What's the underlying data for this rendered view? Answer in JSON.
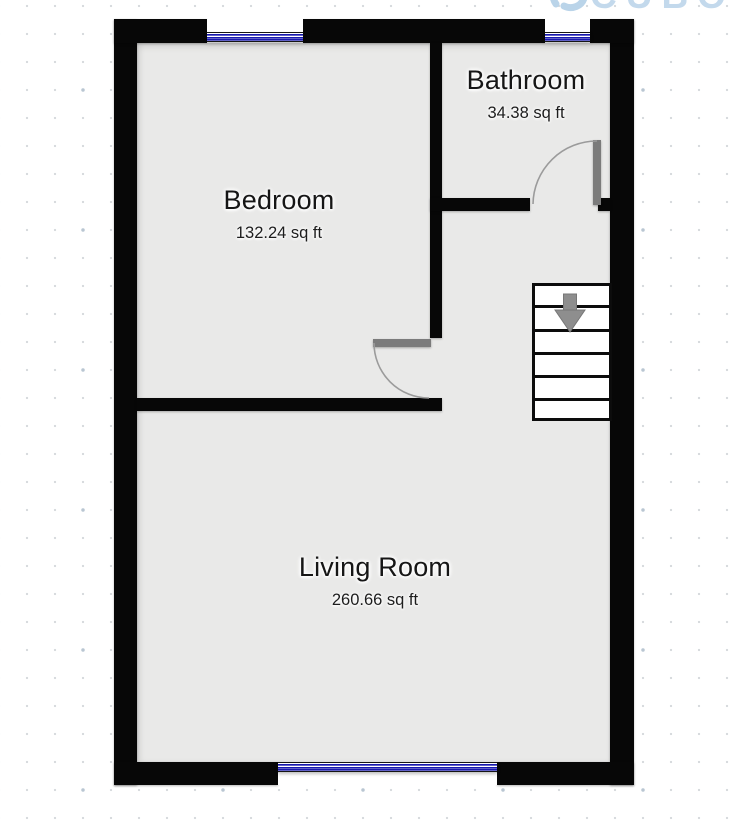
{
  "watermark": {
    "text": "CUBO",
    "color": "#c3d9ec",
    "icon": "swirl-logo"
  },
  "rooms": [
    {
      "id": "bedroom",
      "name": "Bedroom",
      "area": "132.24 sq ft"
    },
    {
      "id": "bathroom",
      "name": "Bathroom",
      "area": "34.38 sq ft"
    },
    {
      "id": "living_room",
      "name": "Living Room",
      "area": "260.66 sq ft"
    }
  ],
  "stairs": {
    "treads": 6,
    "direction_icon": "arrow-down",
    "arrow_color": "#8e8e8e"
  },
  "windows": [
    {
      "location": "top-bedroom",
      "glazing_color": "#1717ae"
    },
    {
      "location": "top-bathroom",
      "glazing_color": "#1717ae"
    },
    {
      "location": "bottom-living",
      "glazing_color": "#1717ae"
    }
  ],
  "doors": [
    {
      "room": "bathroom",
      "swing": "arc"
    },
    {
      "room": "bedroom",
      "swing": "arc"
    }
  ],
  "colors": {
    "wall": "#070707",
    "floor": "#e9e9e8",
    "door_leaf": "#7b7b7b",
    "grid_dot": "#d8dbde"
  }
}
